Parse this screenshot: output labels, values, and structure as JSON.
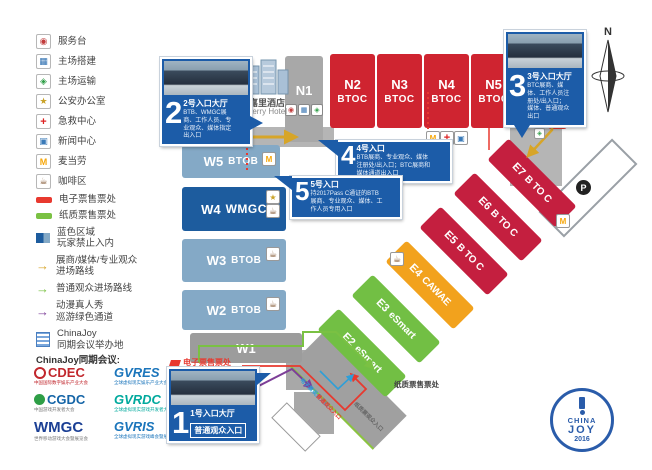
{
  "colors": {
    "accent_blue": "#1c5ca8",
    "hall_red": "#cf2430",
    "hall_crimson": "#c41f3f",
    "hall_green": "#72bf44",
    "hall_orange": "#f2a21d",
    "hall_lightblue": "#84a9c6",
    "hall_navy": "#1d5c9e",
    "route_red": "#e8392f",
    "route_green": "#7ac143",
    "route_gold": "#d7a528",
    "route_purple": "#7d3f98",
    "route_blue": "#2e9fd8",
    "logo_blue": "#2a5caa"
  },
  "legend": {
    "items": [
      {
        "icon": "service-desk-icon",
        "label": "服务台"
      },
      {
        "icon": "venue-setup-icon",
        "label": "主场搭建"
      },
      {
        "icon": "venue-transport-icon",
        "label": "主场运输"
      },
      {
        "icon": "police-office-icon",
        "label": "公安办公室"
      },
      {
        "icon": "first-aid-icon",
        "label": "急救中心"
      },
      {
        "icon": "news-center-icon",
        "label": "新闻中心"
      },
      {
        "icon": "mcdonalds-icon",
        "label": "麦当劳"
      },
      {
        "icon": "coffee-area-icon",
        "label": "咖啡区"
      },
      {
        "icon": "eticket-bar-icon",
        "label": "电子票售票处"
      },
      {
        "icon": "paper-ticket-bar-icon",
        "label": "纸质票售票处"
      },
      {
        "icon": "blue-zone-icon",
        "label": "蓝色区域",
        "label2": "玩家禁止入内"
      },
      {
        "icon": "gold-arrow-icon",
        "label": "展商/媒体/专业观众",
        "label2": "进场路线"
      },
      {
        "icon": "green-arrow-icon",
        "label": "普通观众进场路线"
      },
      {
        "icon": "purple-arrow-icon",
        "label": "动漫真人秀",
        "label2": "巡游绿色通道"
      },
      {
        "icon": "chinajoy-venue-icon",
        "label": "ChinaJoy",
        "label2": "同期会议举办地"
      }
    ]
  },
  "conferences": {
    "heading": "ChinaJoy同期会议:",
    "logos": [
      {
        "name": "CDEC",
        "sub": "中国国际数字娱乐产业大会"
      },
      {
        "name": "GVRES",
        "sub": "全球虚拟现实娱乐产业大会"
      },
      {
        "name": "CGDC",
        "sub": "中国游戏开发者大会"
      },
      {
        "name": "GVRDC",
        "sub": "全球虚拟现实游戏开发者大会"
      },
      {
        "name": "WMGC",
        "sub": "世界移动游戏大会暨展览会"
      },
      {
        "name": "GVRIS",
        "sub": "全球虚拟现实游戏峰会暨展览会"
      }
    ]
  },
  "halls": {
    "n": [
      {
        "name": "N1",
        "type": ""
      },
      {
        "name": "N2",
        "type": "BTOC"
      },
      {
        "name": "N3",
        "type": "BTOC"
      },
      {
        "name": "N4",
        "type": "BTOC"
      },
      {
        "name": "N5",
        "type": "BTOC"
      }
    ],
    "w": [
      {
        "name": "W5",
        "type": "BTOB"
      },
      {
        "name": "W4",
        "type": "WMGC"
      },
      {
        "name": "W3",
        "type": "BTOB"
      },
      {
        "name": "W2",
        "type": "BTOB"
      },
      {
        "name": "W1",
        "type": ""
      }
    ],
    "e": [
      {
        "name": "E2",
        "type": "eSmart"
      },
      {
        "name": "E3",
        "type": "eSmart"
      },
      {
        "name": "E4",
        "type": "CAWAE"
      },
      {
        "name": "E5",
        "type": "B TO C"
      },
      {
        "name": "E6",
        "type": "B TO C"
      },
      {
        "name": "E7",
        "type": "B TO C"
      }
    ]
  },
  "entrances": [
    {
      "num": "1",
      "title": "1号入口大厅",
      "badge": "普通观众入口"
    },
    {
      "num": "2",
      "title": "2号入口大厅",
      "desc": "BTB、WMGC展商、工作人员、专业观众、媒体指定出入口"
    },
    {
      "num": "3",
      "title": "3号入口大厅",
      "desc": "BTC展商、媒体、工作人员注册处/出入口；媒体、普通观众出口"
    },
    {
      "num": "4",
      "title": "4号入口",
      "desc": "BTB展商、专业观众、媒体注册处/出入口；BTC展商和媒体通道出入口"
    },
    {
      "num": "5",
      "title": "5号入口",
      "desc": "持2017Pass C通证的BTB展商、专业观众、媒体、工作人员专用入口"
    }
  ],
  "labels": {
    "kerry_cn": "嘉里酒店",
    "kerry_en": "Kerry Hotel",
    "eticket_office": "电子票售票处",
    "paper_office": "纸质票售票处",
    "p1": "P1",
    "p": "P",
    "compass_n": "N",
    "route_eticket": "电子票观众入口",
    "route_general": "普通观众入口",
    "route_paper": "纸质票观众入口",
    "cj_china": "CHINA",
    "cj_joy": "JOY",
    "cj_year": "2016"
  }
}
